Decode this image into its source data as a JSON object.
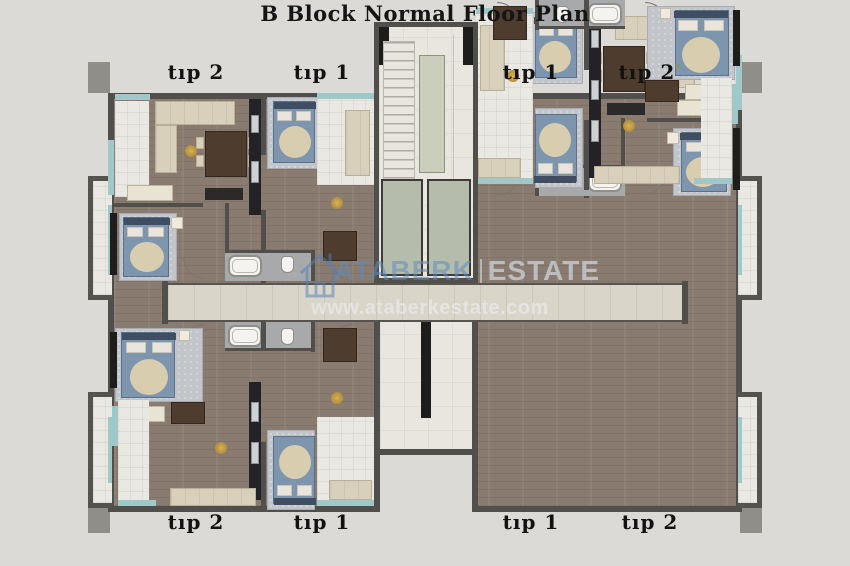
{
  "title": "B Block Normal Floor Plan",
  "units": {
    "top": [
      {
        "label": "tıp 2"
      },
      {
        "label": "tıp 1"
      },
      {
        "label": "tıp 1"
      },
      {
        "label": "tıp 2",
        "note_mark": "*"
      }
    ],
    "bottom": [
      {
        "label": "tıp 2"
      },
      {
        "label": "tıp 1"
      },
      {
        "label": "tıp 1"
      },
      {
        "label": "tıp 2"
      }
    ]
  },
  "watermark": {
    "brand_primary": "ATABERK",
    "brand_secondary": "ESTATE",
    "url": "www.ataberkestate.com",
    "logo": "house-icon"
  },
  "colors": {
    "background": "#dbdad6",
    "wall_gray": "#514f4b",
    "wood_floor": "#897b6f",
    "accent_teal": "#a0c8c9",
    "watermark_blue": "#5f8cbe"
  }
}
